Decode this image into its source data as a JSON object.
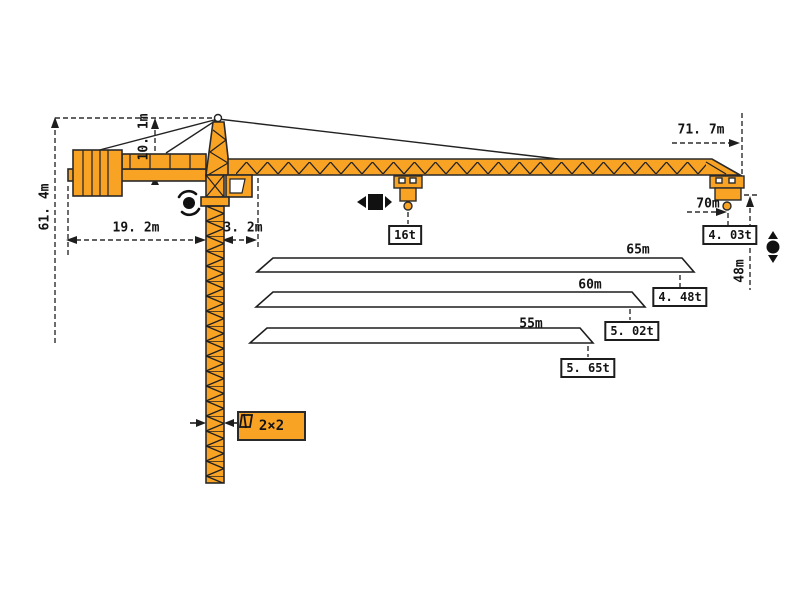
{
  "diagram": {
    "type": "tower-crane-specification-drawing",
    "colors": {
      "crane_fill": "#f9a325",
      "outline": "#2a2a2a",
      "line": "#2e2e2e",
      "background": "#ffffff"
    },
    "dimensions": {
      "total_height": "61. 4m",
      "head_height": "10. 1m",
      "counter_jib_length": "19. 2m",
      "tower_to_pivot": "3. 2m",
      "max_jib_length": "71. 7m",
      "tip_radius": "70m",
      "hook_height": "48m"
    },
    "loads": {
      "max_load": "16t",
      "tip_load_70m": "4. 03t"
    },
    "jib_options": [
      {
        "len": "65m",
        "tip_load": "4. 48t"
      },
      {
        "len": "60m",
        "tip_load": "5. 02t"
      },
      {
        "len": "55m",
        "tip_load": "5. 65t"
      }
    ],
    "tower_section": "2×2",
    "icons": {
      "slewing_icon": "rotation-arrows",
      "trolley_icon": "trolley-travel-arrows",
      "hoist_icon": "hook-up-down-arrows",
      "section_icon": "mast-cross-section"
    }
  }
}
